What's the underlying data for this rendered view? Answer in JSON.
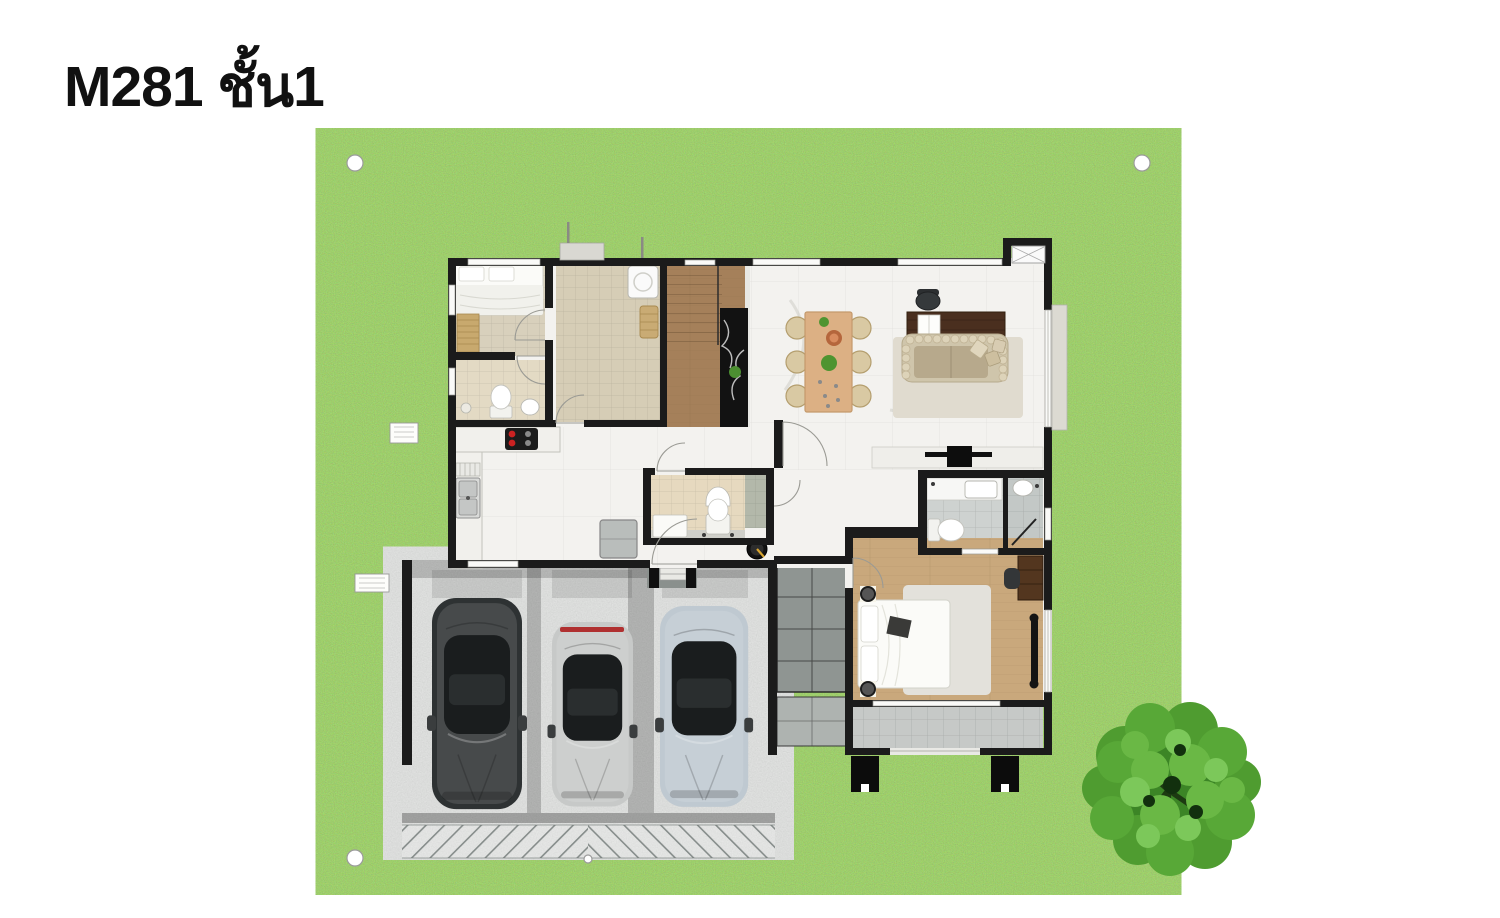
{
  "title": "M281 ชั้น1",
  "palette": {
    "background": "#ffffff",
    "lawn": "#57a22d",
    "wall": "#1b1b1b",
    "marble_floor": "#f3f2ef",
    "tile_beige": "#d8d0bc",
    "tile_bath_beige": "#e3dac4",
    "tile_utility": "#d6cdb6",
    "tile_gray": "#ced2d0",
    "wood_stairs": "#a5805a",
    "marble_black": "#121212",
    "wood_bedroom": "#c9a87c",
    "concrete": "#b6bab8",
    "concrete_dark": "#868c8a",
    "driveway": "#c3c7c5",
    "walkway_dark": "#8f9592",
    "terrace_tile": "#c6c9c7",
    "sofa": "#cfc5ab",
    "rug": "#e0dbcf",
    "dining_wood": "#dcb084",
    "desk_wood": "#4a2f1f",
    "car_black": "#2e3233",
    "car_silver": "#c7c9c8",
    "car_blue": "#bfc9d1",
    "tree": "#3c8526",
    "burner_red": "#cc2222",
    "gold_accent": "#d8a530"
  },
  "plan": {
    "rooms": [
      "lawn",
      "carport",
      "driveway",
      "entry-porch",
      "walkway",
      "kitchen",
      "corridor",
      "central-bathroom",
      "foyer",
      "staircase",
      "bedroom-1",
      "bathroom-1",
      "utility-room",
      "living-dining-room",
      "master-bedroom",
      "master-bathroom",
      "terrace"
    ],
    "furniture": [
      "single-bed",
      "slat-bench",
      "toilet",
      "washbasin",
      "washing-machine",
      "laundry-basket",
      "stove",
      "kitchen-sink",
      "dish-rack",
      "refrigerator",
      "dining-table",
      "dining-chair",
      "decor-bowl",
      "table-plant",
      "work-desk",
      "office-chair",
      "open-book",
      "corner-sofa",
      "area-rug",
      "throw-pillow",
      "tv-console",
      "television",
      "floor-mat",
      "double-bed",
      "ceiling-speaker",
      "wardrobe",
      "bedroom-chair",
      "vanity-counter",
      "shower-enclosure",
      "air-conditioner",
      "marble-feature-wall",
      "potted-plant",
      "door-swing",
      "window",
      "terrace-pillar",
      "survey-marker"
    ],
    "vehicles": [
      "suv-black",
      "sports-car-silver",
      "sedan-silver-blue"
    ],
    "landscape": [
      "lawn",
      "garden-tree"
    ]
  }
}
